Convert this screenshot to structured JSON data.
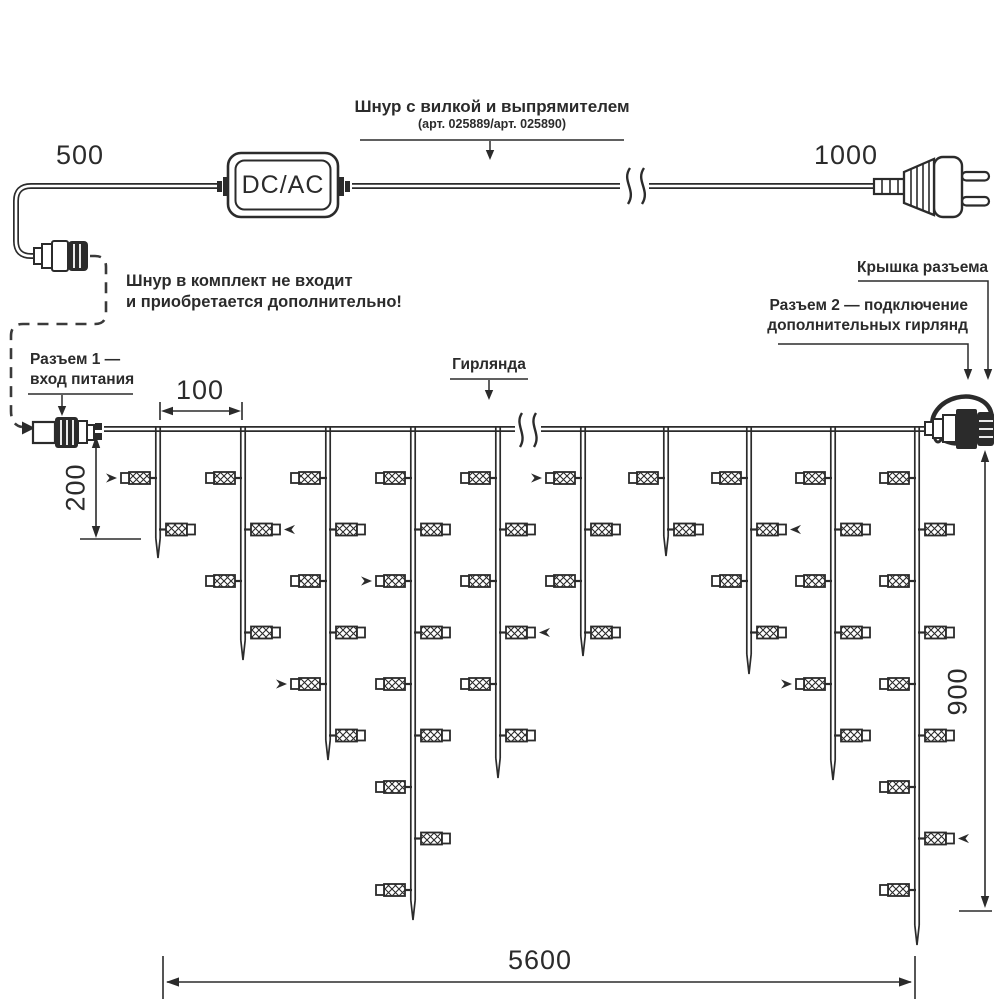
{
  "colors": {
    "ink": "#2b2b2b",
    "background": "#ffffff"
  },
  "header": {
    "cord_label": "Шнур с вилкой и выпрямителем",
    "cord_article": "(арт. 025889/арт. 025890)",
    "converter_label": "DC/AC",
    "cord_left_length": "500",
    "cord_right_length": "1000"
  },
  "notes": {
    "not_included_line1": "Шнур в комплект не входит",
    "not_included_line2": "и приобретается дополнительно!"
  },
  "callouts": {
    "connector1_line1": "Разъем 1 —",
    "connector1_line2": "вход питания",
    "garland_label": "Гирлянда",
    "cap_label": "Крышка разъема",
    "connector2_line1": "Разъем 2 — подключение",
    "connector2_line2": "дополнительных гирлянд"
  },
  "dimensions": {
    "drop_spacing": "100",
    "first_drop_length": "200",
    "garland_height": "900",
    "garland_width": "5600"
  },
  "garland": {
    "wire_y": 429,
    "lamp_first_y": 478,
    "lamp_spacing": 51.5,
    "drops": [
      {
        "x": 158,
        "lamps": 2,
        "tip": 558,
        "arrow_at": 0
      },
      {
        "x": 243,
        "lamps": 4,
        "tip": 660,
        "arrow_at": 1
      },
      {
        "x": 328,
        "lamps": 6,
        "tip": 760,
        "arrow_at": 4
      },
      {
        "x": 413,
        "lamps": 9,
        "tip": 920,
        "arrow_at": 2
      },
      {
        "x": 498,
        "lamps": 6,
        "tip": 778,
        "arrow_at": 3
      },
      {
        "x": 583,
        "lamps": 4,
        "tip": 656,
        "arrow_at": 0
      },
      {
        "x": 666,
        "lamps": 2,
        "tip": 556,
        "arrow_at": null
      },
      {
        "x": 749,
        "lamps": 4,
        "tip": 674,
        "arrow_at": 1
      },
      {
        "x": 833,
        "lamps": 6,
        "tip": 780,
        "arrow_at": 4
      },
      {
        "x": 917,
        "lamps": 9,
        "tip": 945,
        "arrow_at": 7
      }
    ]
  }
}
